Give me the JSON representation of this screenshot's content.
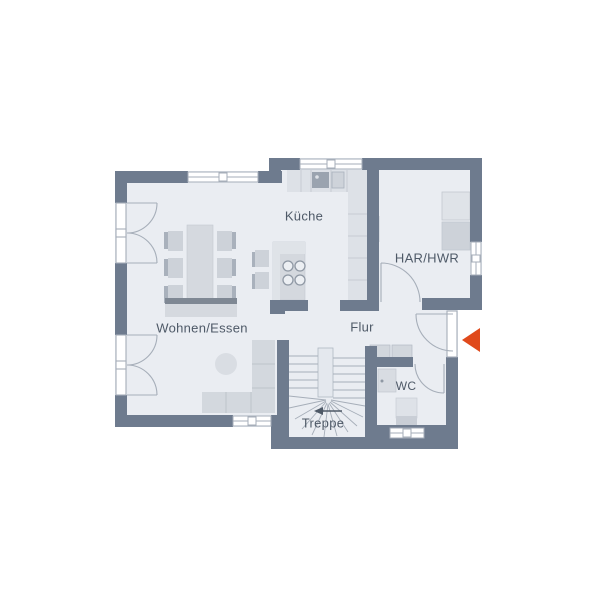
{
  "floorplan": {
    "rooms": {
      "wohnen_essen": "Wohnen/Essen",
      "kueche": "Küche",
      "har_hwr": "HAR/HWR",
      "flur": "Flur",
      "wc": "WC",
      "treppe": "Treppe"
    },
    "icons": {
      "entrance_arrow": "red triangle pointing left at entrance door",
      "stairs_direction_arrow": "small arrow pointing left above Treppe label"
    },
    "colors": {
      "wall": "#6e7b8e",
      "floor": "#eaedf2",
      "furniture_light": "#d5d9df",
      "furniture_mid": "#cdd2d9",
      "appliance_dark": "#9aa3af",
      "outline": "#a6aeb9",
      "entrance_arrow": "#e04a1c",
      "label_text": "#4e5967"
    }
  }
}
